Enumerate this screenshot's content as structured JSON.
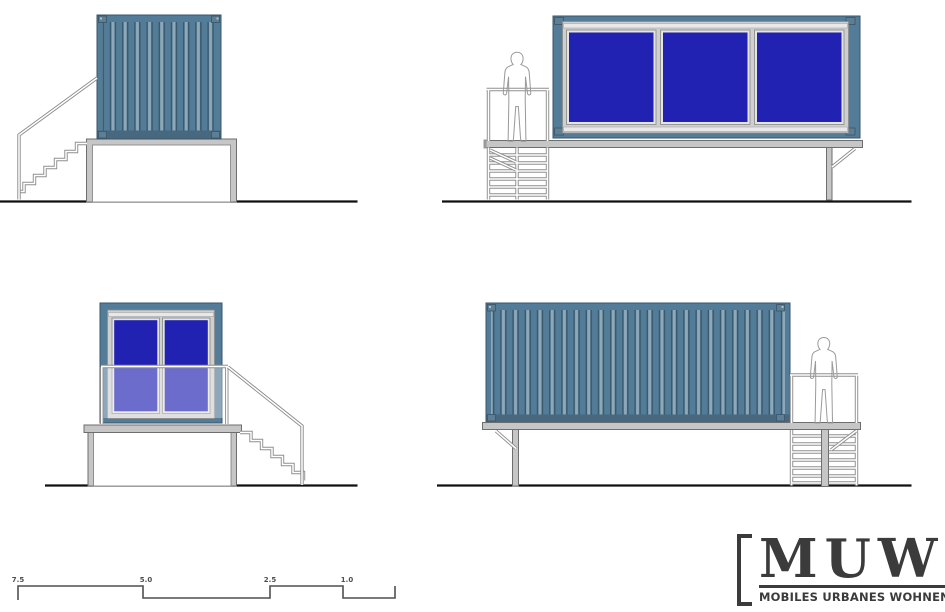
{
  "document": {
    "kind": "architectural elevation drawing sheet",
    "background": "#FFFFFF"
  },
  "colors": {
    "sheet_bg": "#FFFFFF",
    "container": "#527C97",
    "container_dark": "#39566B",
    "container_bottom": "#47687F",
    "corrugation_dark": "#3A5A70",
    "corrugation_light": "#8CA8B9",
    "window_blue": "#2121B2",
    "frame_light": "#CFCFCF",
    "frame_lighter": "#E8E8E8",
    "structure_gray": "#C6C6C6",
    "structure_stroke": "#6E6E6E",
    "rail_gray": "#8F8F8F",
    "silhouette_gray": "#9C9C9C",
    "ground_black": "#111111",
    "scale_gray": "#4F4F4F",
    "logo_dark": "#3B3B3B"
  },
  "scale_bar": {
    "labels": [
      "7.5",
      "5.0",
      "2.5",
      "1.0"
    ]
  },
  "logo": {
    "acronym": "MUW",
    "subtitle": "MOBILES URBANES WOHNEN",
    "bracket_left": "[",
    "bracket_right": "]"
  }
}
